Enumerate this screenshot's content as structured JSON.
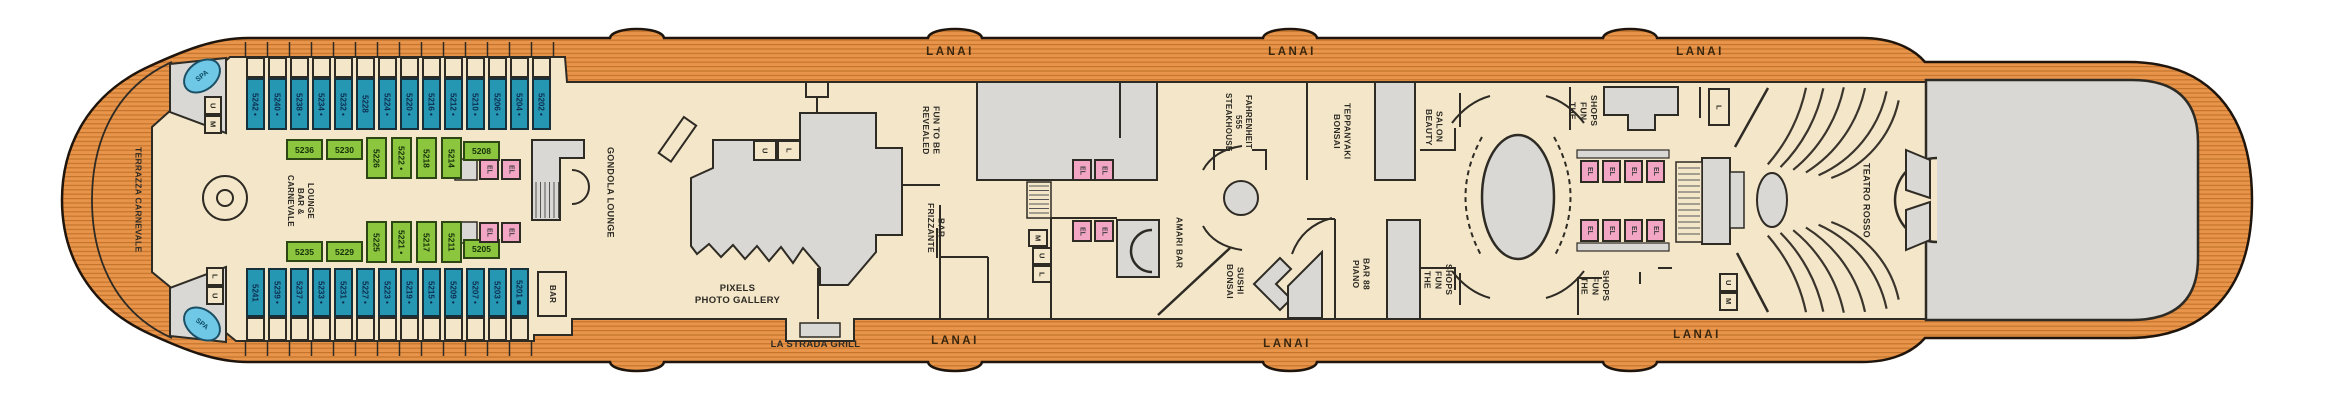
{
  "deck": {
    "lanai_label": "LANAI",
    "terrazza_label": "TERRAZZA CARNEVALE",
    "spa_label": "SPA",
    "la_strada_label": "LA STRADA GRILL"
  },
  "venues": {
    "carnevale": "CARNEVALE\nBAR &\nLOUNGE",
    "gondola": "GONDOLA LOUNGE",
    "bar": "BAR",
    "pixels": "PIXELS\nPHOTO GALLERY",
    "fun_to_be": "FUN TO BE\nREVEALED",
    "frizzante": "FRIZZANTE\nBAR",
    "amari": "AMARI BAR",
    "fahrenheit": "FAHRENHEIT\n555\nSTEAKHOUSE",
    "bonsai_sushi": "BONSAI\nSUSHI",
    "bonsai_teppanyaki": "BONSAI\nTEPPANYAKI",
    "beauty_salon": "BEAUTY\nSALON",
    "piano_bar": "PIANO\nBAR 88",
    "fun_shops": "THE\nFUN\nSHOPS",
    "teatro": "TEATRO ROSSO"
  },
  "elevator_label": "EL",
  "stairs": {
    "bow_top": [
      "U",
      "M"
    ],
    "bow_bottom": [
      "L",
      "U"
    ],
    "pixels": [
      "U",
      "L"
    ],
    "center": [
      "M",
      "U",
      "L"
    ],
    "theater_top": [
      "L"
    ],
    "theater_bottom": [
      "U",
      "M"
    ]
  },
  "cabins": {
    "top_blue": [
      "5242 •",
      "5240 •",
      "5238 •",
      "5234 •",
      "5232 •",
      "5228",
      "5224 •",
      "5220 •",
      "5216 •",
      "5212 •",
      "5210 •",
      "5206 •",
      "5204 •",
      "5202 •"
    ],
    "upper_green": [
      "5236",
      "5230",
      "5226",
      "5222 •",
      "5218",
      "5214",
      "5208"
    ],
    "lower_green": [
      "5235",
      "5229",
      "5225",
      "5221 •",
      "5217",
      "5211",
      "5205"
    ],
    "bottom_blue": [
      "5241",
      "5239 •",
      "5237 •",
      "5233 •",
      "5231 •",
      "5227 •",
      "5223 •",
      "5219 •",
      "5215 •",
      "5209 •",
      "5207 •",
      "5203 •",
      "5201 ■"
    ]
  },
  "colors": {
    "deck_orange": "#E8954B",
    "deck_stripe": "#C4742C",
    "interior_cream": "#F4E7C9",
    "room_gray": "#D9D8D4",
    "outline": "#2E2A24",
    "cabin_blue": "#2697B3",
    "cabin_green": "#8CC63F",
    "elevator_pink": "#F2A6C4",
    "spa_blue": "#6FC8E6"
  }
}
